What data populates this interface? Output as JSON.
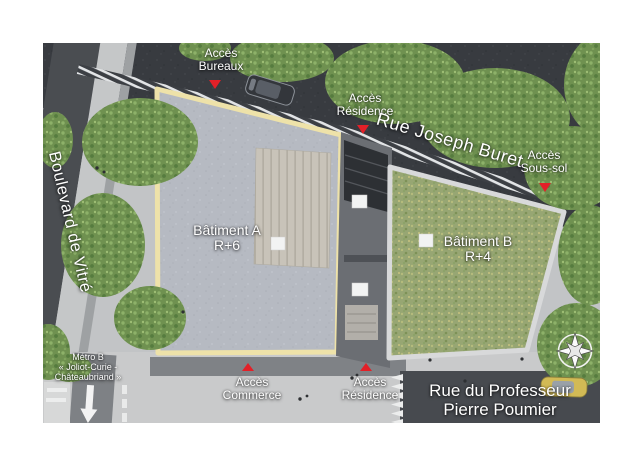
{
  "plan_type": "aerial-site-plan",
  "streets": {
    "rue_joseph_buret": "Rue Joseph Buret",
    "boulevard_de_vitre": "Boulevard de Vitré",
    "rue_du_professeur": {
      "line1": "Rue du Professeur",
      "line2": "Pierre Poumier"
    }
  },
  "buildings": {
    "a": {
      "name": "Bâtiment A",
      "floors": "R+6"
    },
    "b": {
      "name": "Bâtiment B",
      "floors": "R+4"
    }
  },
  "access": {
    "bureaux": {
      "line1": "Accès",
      "line2": "Bureaux"
    },
    "residence_nord": {
      "line1": "Accès",
      "line2": "Résidence"
    },
    "sous_sol": {
      "line1": "Accès",
      "line2": "Sous-sol"
    },
    "commerce": {
      "line1": "Accès",
      "line2": "Commerce"
    },
    "residence_sud": {
      "line1": "Accès",
      "line2": "Résidence"
    }
  },
  "metro": {
    "line1": "Métro B",
    "line2": "« Joliot-Curie -",
    "line3": "Châteaubriand »"
  },
  "icons": {
    "compass": "compass-rose",
    "access_marker": "red-triangle-arrow",
    "metro_arrow": "white-down-arrow"
  },
  "colors": {
    "street_dark": "#383b40",
    "road_bottom": "#474a4f",
    "sidewalk": "#c9cacb",
    "building_a_roof": "#b6bac2",
    "building_a_outline": "#eee2a9",
    "building_b_roof": "#97a673",
    "building_b_outline": "#d8d9da",
    "tree_green": "#6f9150",
    "marker_red": "#e32028",
    "deck_wood": "#c8c3b9"
  }
}
